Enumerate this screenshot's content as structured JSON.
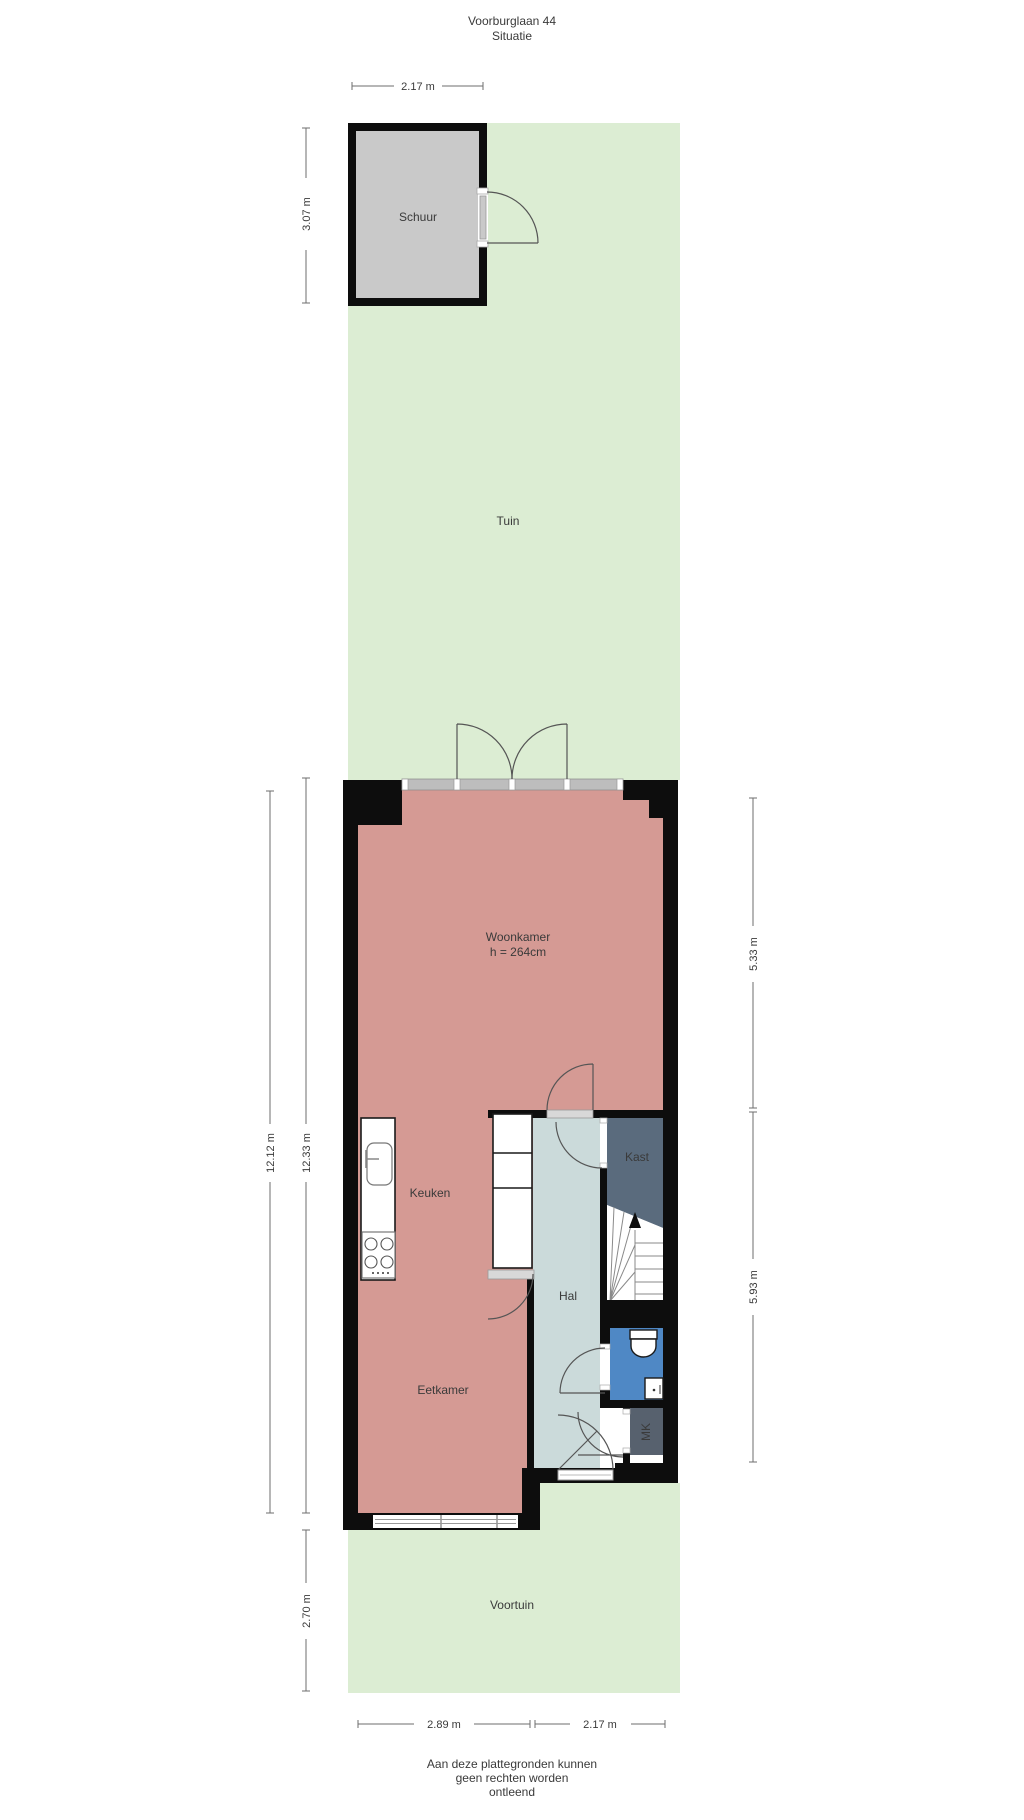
{
  "title": {
    "line1": "Voorburglaan 44",
    "line2": "Situatie"
  },
  "labels": {
    "schuur": "Schuur",
    "tuin": "Tuin",
    "woonkamer": "Woonkamer",
    "woonkamer_ceiling": "h = 264cm",
    "keuken": "Keuken",
    "kast": "Kast",
    "hal": "Hal",
    "eetkamer": "Eetkamer",
    "mk": "MK",
    "voortuin": "Voortuin"
  },
  "dimensions": {
    "schuur_width": "2.17 m",
    "schuur_depth": "3.07 m",
    "plot_depth_outer": "12.12 m",
    "plot_depth_inner": "12.33 m",
    "woonkamer_depth": "5.33 m",
    "hal_depth": "5.93 m",
    "voortuin_depth": "2.70 m",
    "house_width_left": "2.89 m",
    "house_width_right": "2.17 m"
  },
  "footer": {
    "line1": "Aan deze plattegronden kunnen",
    "line2": "geen rechten worden",
    "line3": "ontleend"
  },
  "colors": {
    "garden_green": "#dcedd3",
    "floor_pink": "#d59a94",
    "hall_blue_gray": "#cbdada",
    "closet_slate": "#5a6b7d",
    "meter_slate": "#57616e",
    "toilet_blue": "#4f88c5",
    "shed_gray": "#c9c9c9",
    "wall_black": "#0d0d0d"
  }
}
